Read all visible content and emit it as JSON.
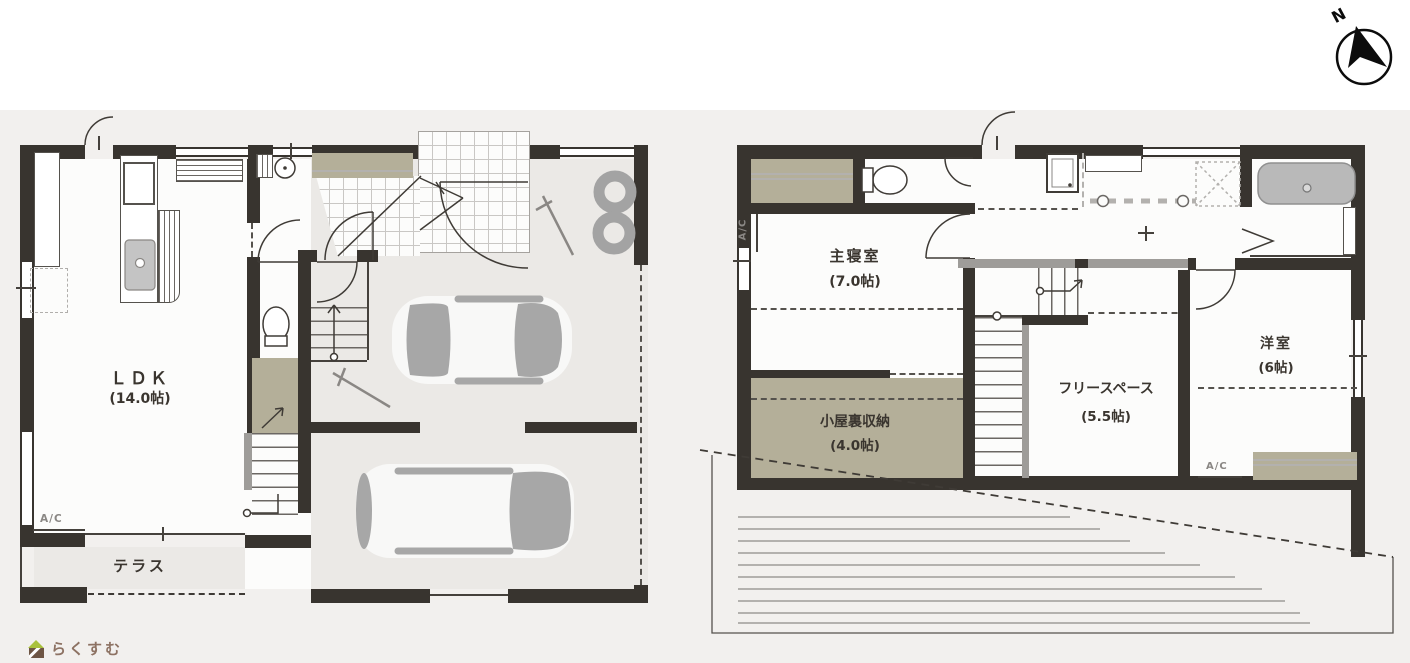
{
  "compass": {
    "label": "N"
  },
  "logo": {
    "text": "らくすむ"
  },
  "floor1": {
    "ldk": {
      "name": "ＬＤＫ",
      "size": "(14.0帖)"
    },
    "terrace": {
      "name": "テラス"
    },
    "ac": "A/C"
  },
  "floor2": {
    "master_bedroom": {
      "name": "主寝室",
      "size": "(7.0帖)"
    },
    "attic_storage": {
      "name": "小屋裏収納",
      "size": "(4.0帖)"
    },
    "free_space": {
      "name": "フリースペース",
      "size": "(5.5帖)"
    },
    "western_room": {
      "name": "洋室",
      "size": "(6帖)"
    },
    "ac_left": "A/C",
    "ac_right": "A/C"
  },
  "colors": {
    "wall": "#38342f",
    "closet_fill": "#b4af99",
    "floor_gray": "#ebe9e6",
    "fixture_gray": "#a7a7a7",
    "background": "#f2f0ee",
    "logo_roof": "#a9c13c",
    "logo_body": "#6e5544",
    "logo_text": "#8d7263"
  }
}
